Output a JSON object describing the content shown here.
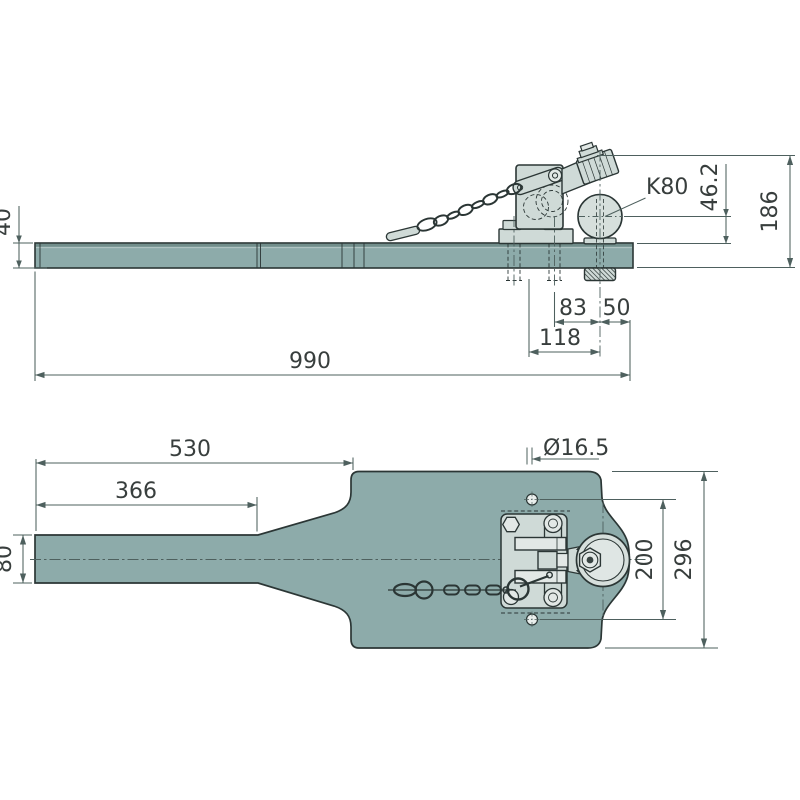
{
  "drawing": {
    "type": "technical-drawing",
    "subject": "drawbar with K80 ball coupling, two orthographic views",
    "views": {
      "side": {
        "dimensions": {
          "bar_height": "40",
          "overall_length": "990",
          "hole_to_ball_center": "118",
          "bolt_to_ball_center": "83",
          "ball_center_to_bar_end": "50",
          "ball_center_height": "46.2",
          "overall_height": "186"
        },
        "annotations": {
          "coupling_label": "K80"
        }
      },
      "top": {
        "dimensions": {
          "length_to_plate": "530",
          "straight_bar_length": "366",
          "bar_width": "80",
          "hole_diameter": "Ø16.5",
          "hole_spacing": "200",
          "plate_width": "296"
        }
      }
    }
  },
  "colors": {
    "part": "#8dabaa",
    "part_dark": "#6d8886",
    "part_light": "#b5c8c6",
    "hw": "#cfdad7",
    "hw2": "#e2e8e6",
    "ball": "#d6dfdc",
    "ball2": "#dfe6e4",
    "ink": "#2b3635",
    "dim": "#4e605e",
    "txt": "#383e3d",
    "bg": "#ffffff"
  }
}
